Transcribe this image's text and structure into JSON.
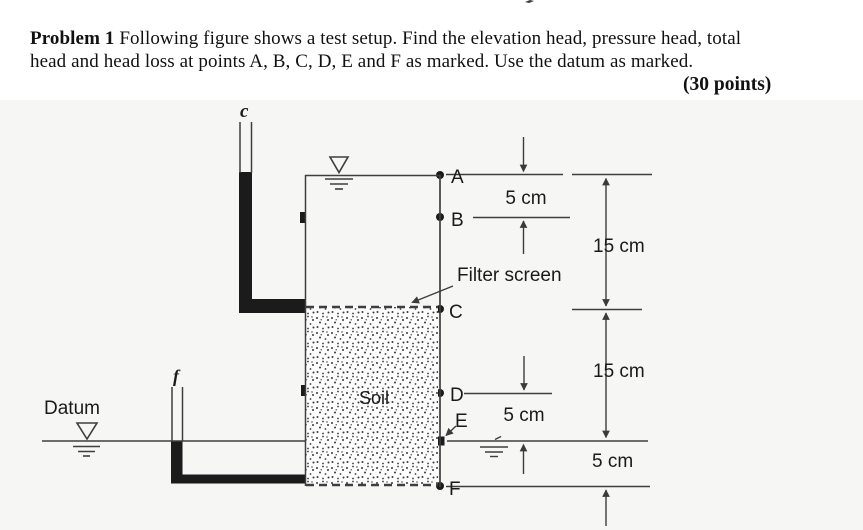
{
  "header": {
    "problem_label": "Problem 1",
    "line1_rest": "Following figure shows a test setup. Find the elevation head, pressure head, total",
    "line2": "head and head loss at points A, B, C, D, E and F as marked. Use the datum as marked.",
    "points_label": "(30 points)"
  },
  "figure": {
    "standpipe_top_label": "c",
    "standpipe_bottom_label": "f",
    "datum_label": "Datum",
    "soil_label": "Soil",
    "filter_screen_label": "Filter screen",
    "point_labels": {
      "a": "A",
      "b": "B",
      "c": "C",
      "d": "D",
      "e": "E",
      "f": "F"
    },
    "dimensions": {
      "ab": "5 cm",
      "ac": "15 cm",
      "ce": "15 cm",
      "de": "5 cm",
      "ef": "5 cm"
    },
    "line_color": "#3e3e3e",
    "fill_color": "#1b1b1b",
    "text_color": "#1a1a1a",
    "figure_bg": "#f6f6f5"
  }
}
